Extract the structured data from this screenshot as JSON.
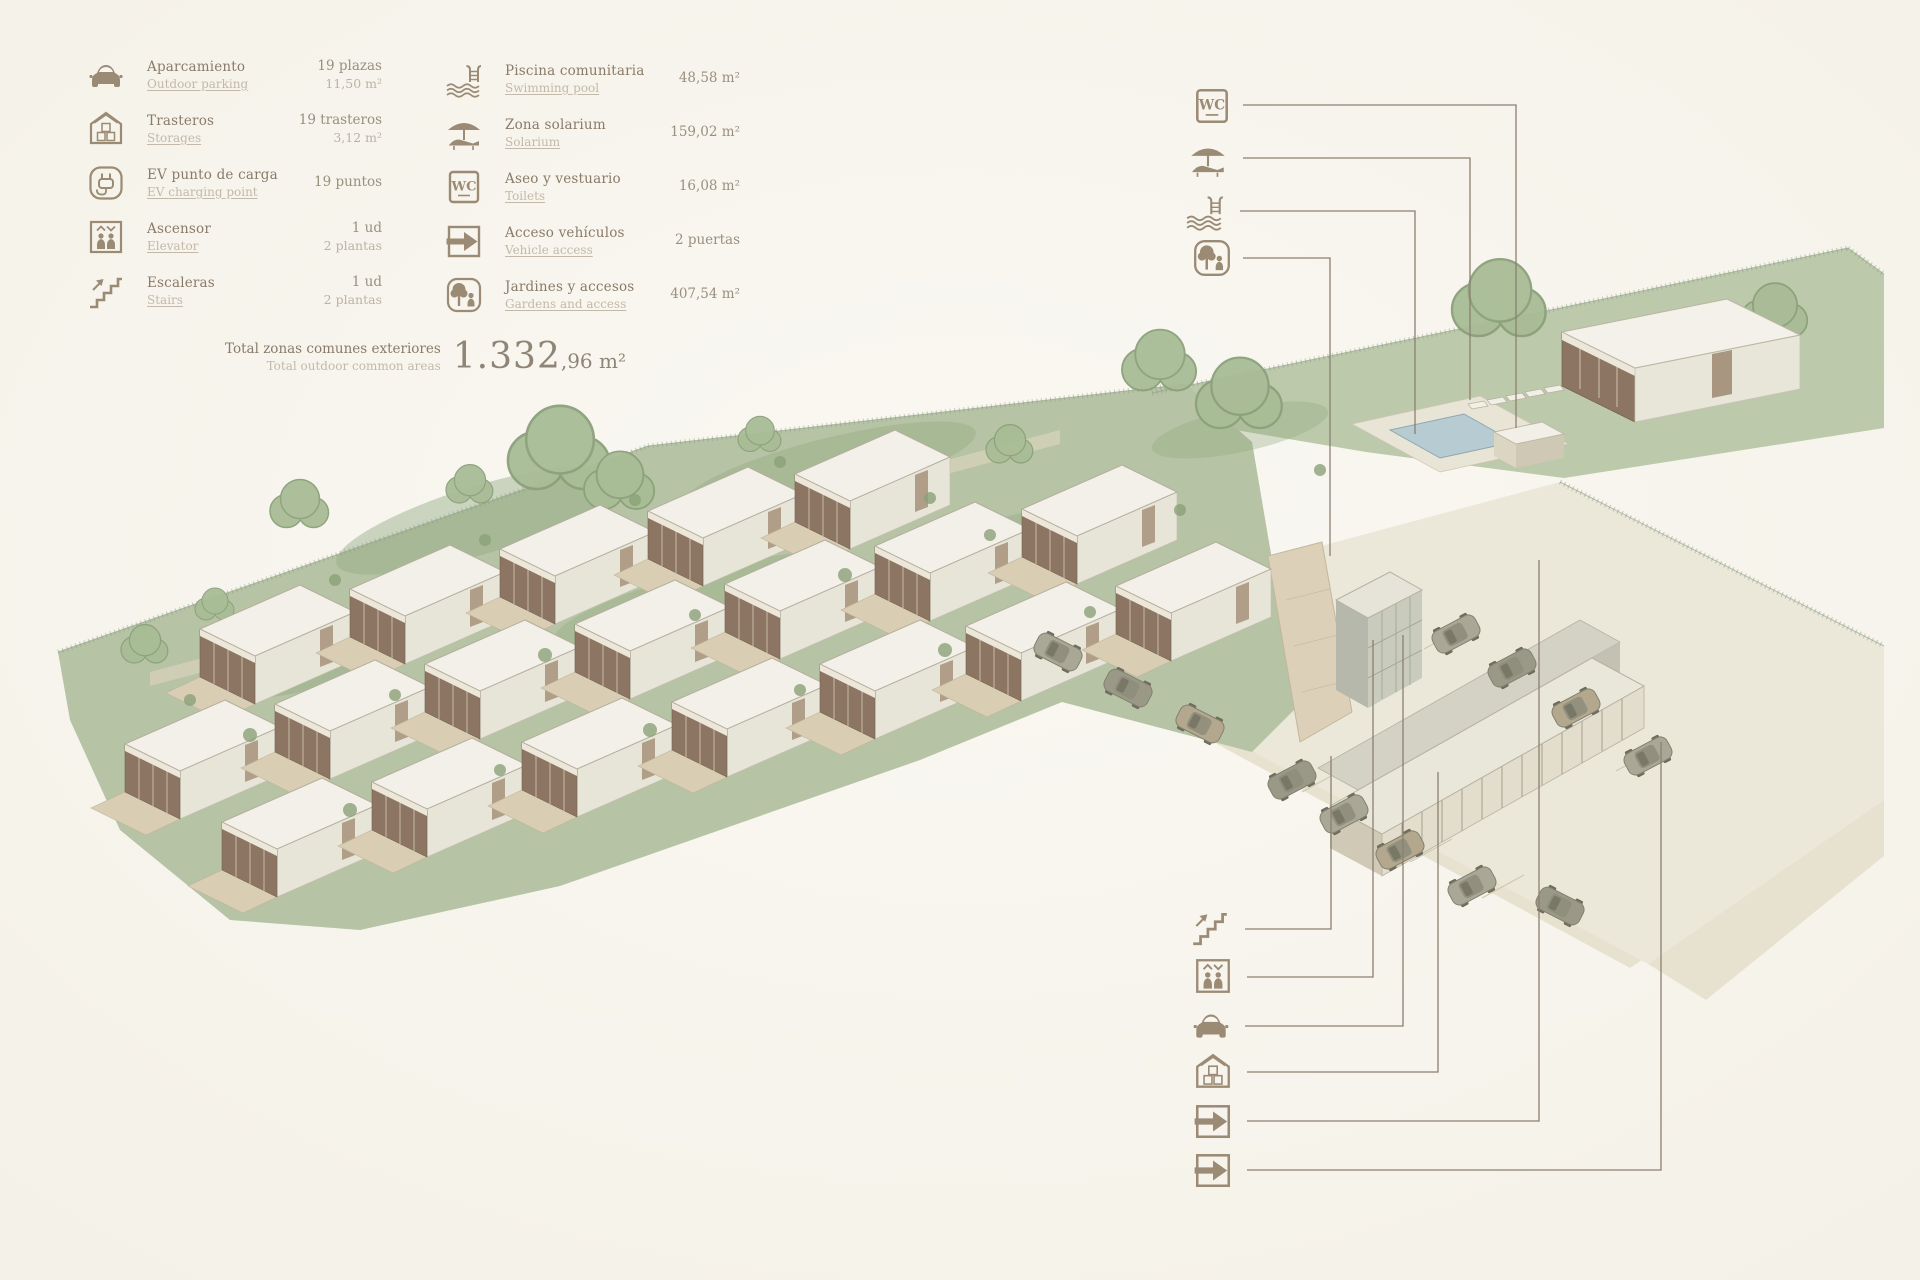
{
  "legend": {
    "col1": [
      {
        "icon": "car-icon",
        "es": "Aparcamiento",
        "en": "Outdoor parking",
        "v1": "19 plazas",
        "v2": "11,50 m²"
      },
      {
        "icon": "storage-icon",
        "es": "Trasteros",
        "en": "Storages",
        "v1": "19 trasteros",
        "v2": "3,12 m²"
      },
      {
        "icon": "ev-charging-icon",
        "es": "EV punto de carga",
        "en": "EV charging point",
        "v1": "19 puntos",
        "v2": ""
      },
      {
        "icon": "elevator-icon",
        "es": "Ascensor",
        "en": "Elevator",
        "v1": "1 ud",
        "v2": "2 plantas"
      },
      {
        "icon": "stairs-icon",
        "es": "Escaleras",
        "en": "Stairs",
        "v1": "1 ud",
        "v2": "2 plantas"
      }
    ],
    "col2": [
      {
        "icon": "pool-icon",
        "es": "Piscina comunitaria",
        "en": "Swimming pool",
        "v1": "48,58 m²",
        "v2": ""
      },
      {
        "icon": "solarium-icon",
        "es": "Zona solarium",
        "en": "Solarium",
        "v1": "159,02 m²",
        "v2": ""
      },
      {
        "icon": "wc-icon",
        "es": "Aseo y vestuario",
        "en": "Toilets",
        "v1": "16,08 m²",
        "v2": ""
      },
      {
        "icon": "vehicle-access-icon",
        "es": "Acceso vehículos",
        "en": "Vehicle access",
        "v1": "2 puertas",
        "v2": ""
      },
      {
        "icon": "gardens-icon",
        "es": "Jardines y accesos",
        "en": "Gardens and access",
        "v1": "407,54 m²",
        "v2": ""
      }
    ],
    "total": {
      "es": "Total zonas comunes exteriores",
      "en": "Total outdoor common areas",
      "value_main": "1.332",
      "value_sub": ",96 m²"
    }
  },
  "wc_glyph": "WC",
  "callouts": {
    "top": [
      "wc-icon",
      "solarium-icon",
      "pool-icon",
      "gardens-icon"
    ],
    "bottom": [
      "stairs-icon",
      "elevator-icon",
      "car-icon",
      "storage-icon",
      "vehicle-access-icon",
      "vehicle-access-icon"
    ]
  },
  "colors": {
    "paper": "#f8f6f0",
    "ink": "#9b8a74",
    "text_primary": "#8a7b69",
    "text_secondary": "#c3b9a8",
    "value_primary": "#99907f",
    "line": "#8b8071",
    "field_green": "#b6c3a4",
    "roof": "#f2f0e9",
    "glass": "#8c7663",
    "terrace": "#d9cdb4",
    "pool_water": "#b7cbd2"
  }
}
